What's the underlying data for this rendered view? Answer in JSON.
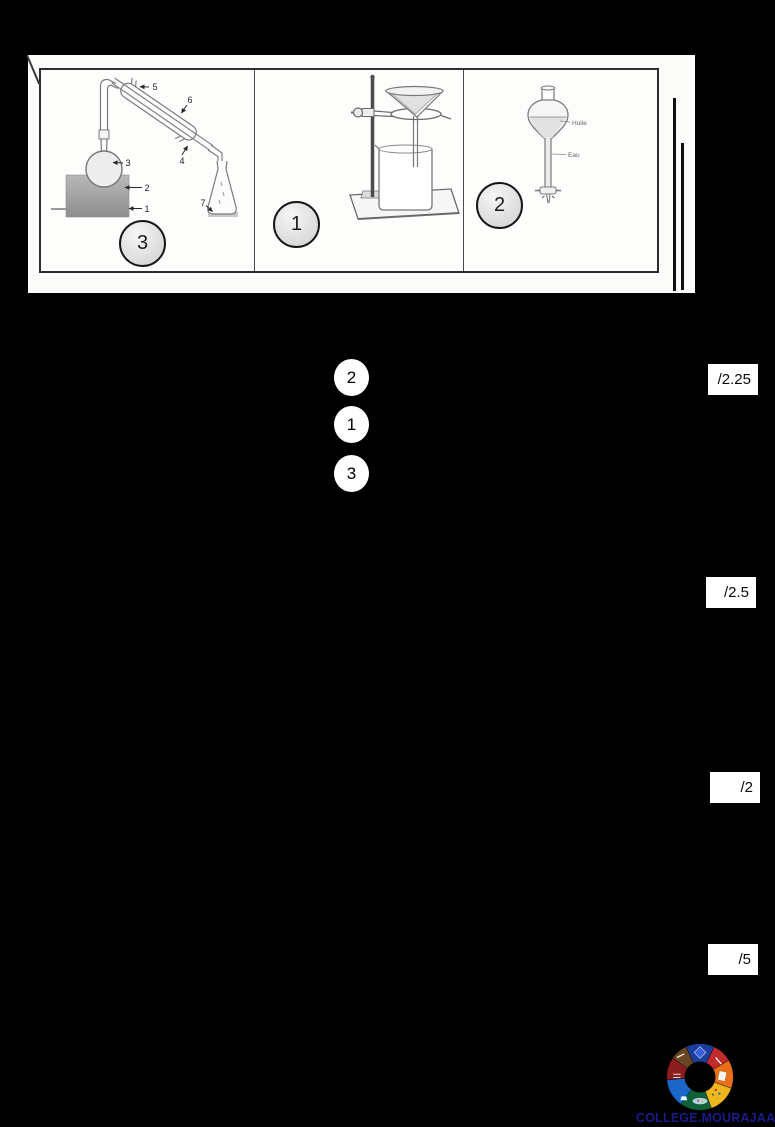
{
  "panel": {
    "cell1": {
      "badge": "3",
      "part1": "1",
      "part2": "2",
      "part3": "3",
      "part4": "4",
      "part5": "5",
      "part6": "6",
      "part7": "7"
    },
    "cell2": {
      "badge": "1"
    },
    "cell3": {
      "badge": "2",
      "layer_top": "Huile",
      "layer_bottom": "Eau"
    }
  },
  "answers": {
    "first": "2",
    "second": "1",
    "third": "3"
  },
  "scores": {
    "box1": "/2.25",
    "box2": "/2.5",
    "box3": "/2",
    "box4": "/5"
  },
  "footer": {
    "site_text": "COLLEGE.MOURAJAA.COM",
    "logo_colors": [
      "#1c3f9e",
      "#c22b2b",
      "#e8701a",
      "#efb71d",
      "#10603a",
      "#1a67c9",
      "#8a1e1e",
      "#6a4524"
    ]
  }
}
